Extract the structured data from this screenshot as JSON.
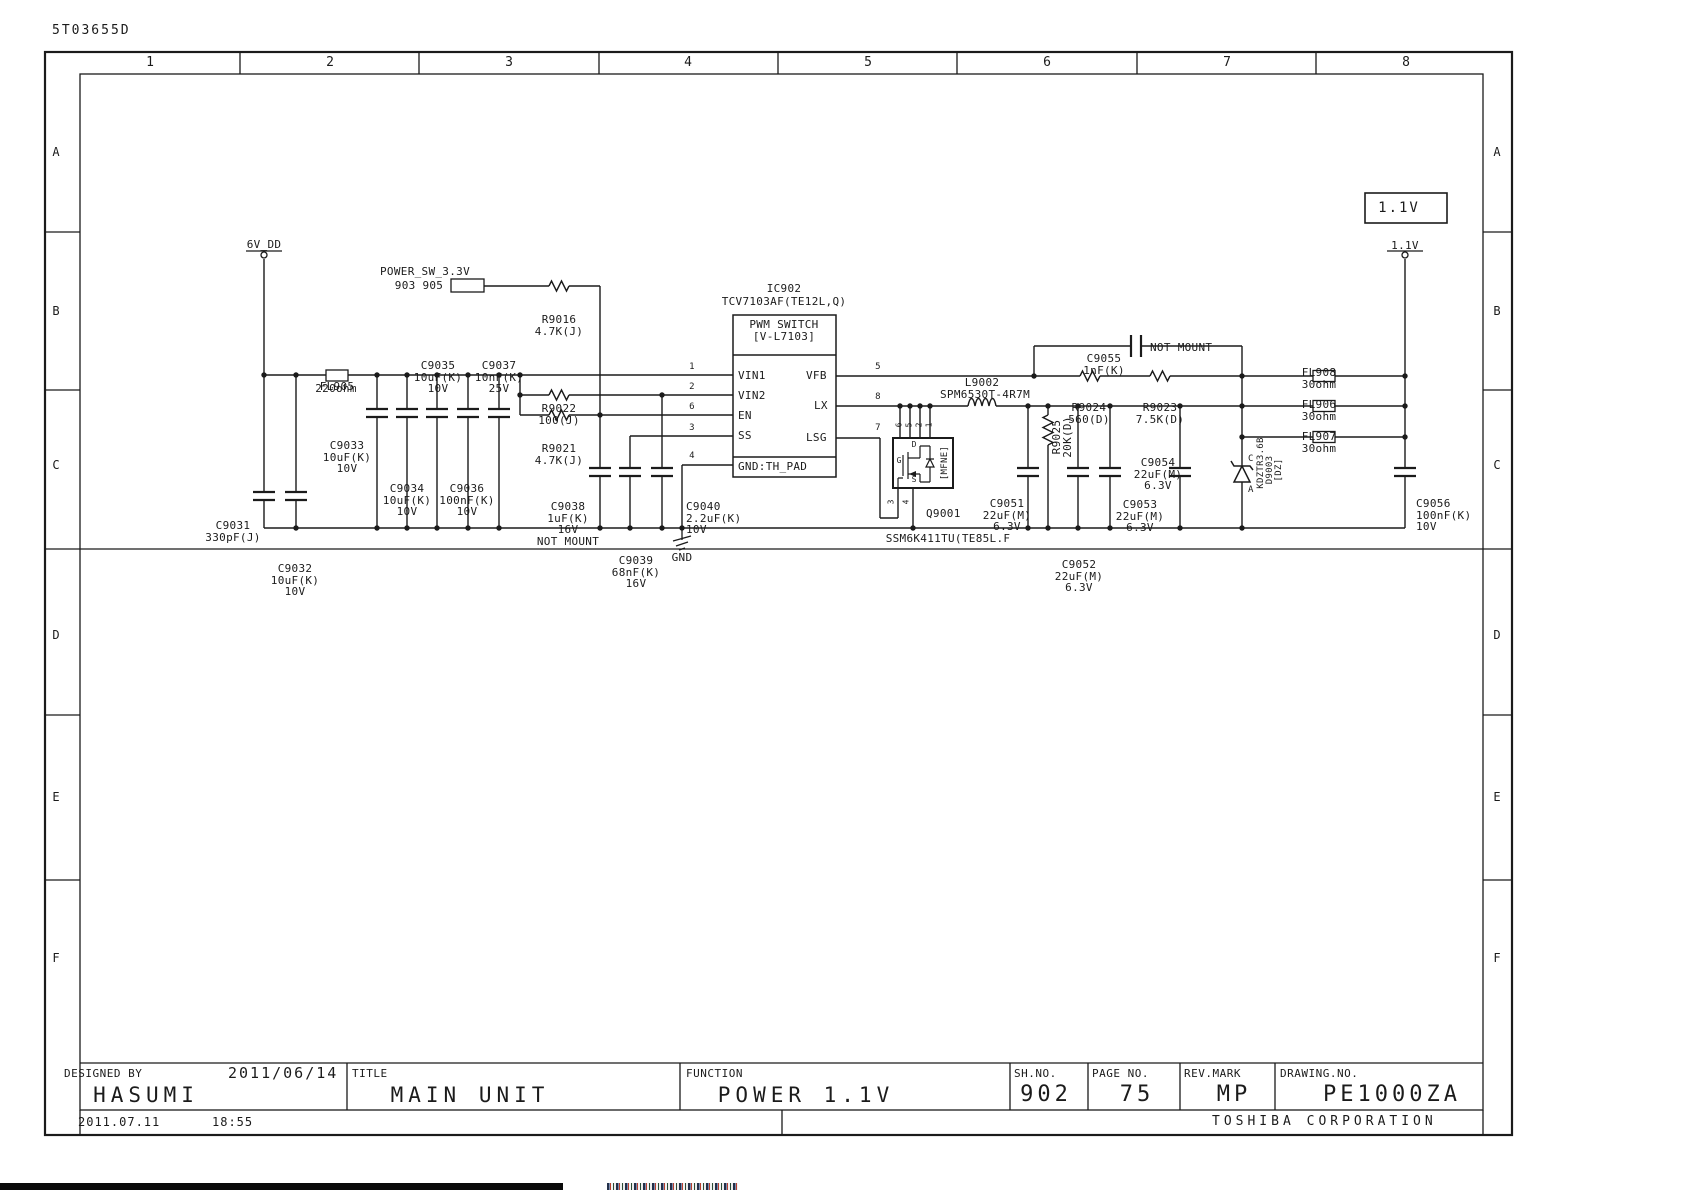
{
  "doc_code": "5T03655D",
  "frame": {
    "columns": [
      "1",
      "2",
      "3",
      "4",
      "5",
      "6",
      "7",
      "8"
    ],
    "rows": [
      "A",
      "B",
      "C",
      "D",
      "E",
      "F"
    ]
  },
  "title_block": {
    "designed_by_label": "DESIGNED BY",
    "design_date": "2011/06/14",
    "designer": "HASUMI",
    "title_label": "TITLE",
    "title": "MAIN UNIT",
    "function_label": "FUNCTION",
    "function": "POWER 1.1V",
    "sheet_no_label": "SH.NO.",
    "sheet_no": "902",
    "page_no_label": "PAGE NO.",
    "page_no": "75",
    "rev_mark_label": "REV.MARK",
    "rev_mark": "MP",
    "drawing_no_label": "DRAWING.NO.",
    "drawing_no": "PE1000ZA",
    "company": "TOSHIBA CORPORATION",
    "print_date": "2011.07.11",
    "print_time": "18:55"
  },
  "nets": {
    "vdd": "6V_DD",
    "power_sw": "POWER_SW_3.3V",
    "power_sw_sheets": "903 905",
    "output_flag": "1.1V",
    "output_net": "1.1V",
    "gnd": "GND"
  },
  "ic902": {
    "ref": "IC902",
    "part": "TCV7103AF(TE12L,Q)",
    "function1": "PWM SWITCH",
    "function2": "[V-L7103]",
    "pins": {
      "vin1": "VIN1",
      "vin2": "VIN2",
      "en": "EN",
      "ss": "SS",
      "gnd_pad": "GND:TH_PAD",
      "vfb": "VFB",
      "lx": "LX",
      "lsg": "LSG",
      "n1": "1",
      "n2": "2",
      "n6": "6",
      "n3": "3",
      "n4": "4",
      "n5": "5",
      "n8": "8",
      "n7": "7"
    }
  },
  "q9001": {
    "ref": "Q9001",
    "part": "SSM6K411TU(TE85L.F",
    "package": "[MFNE]",
    "pin_top_1": "6",
    "pin_top_2": "5",
    "pin_top_3": "2",
    "pin_top_4": "1",
    "pin_bot_1": "3",
    "pin_bot_2": "4",
    "gate": "G",
    "drain": "D",
    "source": "S"
  },
  "d9003": {
    "cathode": "C",
    "anode": "A",
    "part": "KDZTR3.6B",
    "ref": "D9003",
    "type": "[DZ]"
  },
  "l9002": {
    "ref": "L9002",
    "part": "SPM6530T-4R7M"
  },
  "components": {
    "fl905": {
      "ref": "FL905",
      "value": "220ohm"
    },
    "fl906": {
      "ref": "FL906",
      "value": "30ohm"
    },
    "fl907": {
      "ref": "FL907",
      "value": "30ohm"
    },
    "fl908": {
      "ref": "FL908",
      "value": "30ohm"
    },
    "r9016": {
      "ref": "R9016",
      "value": "4.7K(J)"
    },
    "r9021": {
      "ref": "R9021",
      "value": "4.7K(J)"
    },
    "r9022": {
      "ref": "R9022",
      "value": "100(J)"
    },
    "r9023": {
      "ref": "R9023",
      "value": "7.5K(D)"
    },
    "r9024": {
      "ref": "R9024",
      "value": "560(D)"
    },
    "r9025": {
      "ref": "R9025",
      "value": "20K(D)"
    },
    "c9031": {
      "ref": "C9031",
      "value": "330pF(J)"
    },
    "c9032": {
      "ref": "C9032",
      "value": "10uF(K)",
      "voltage": "10V"
    },
    "c9033": {
      "ref": "C9033",
      "value": "10uF(K)",
      "voltage": "10V"
    },
    "c9034": {
      "ref": "C9034",
      "value": "10uF(K)",
      "voltage": "10V"
    },
    "c9035": {
      "ref": "C9035",
      "value": "10uF(K)",
      "voltage": "10V"
    },
    "c9036": {
      "ref": "C9036",
      "value": "100nF(K)",
      "voltage": "10V"
    },
    "c9037": {
      "ref": "C9037",
      "value": "10nF(K)",
      "voltage": "25V"
    },
    "c9038": {
      "ref": "C9038",
      "value": "1uF(K)",
      "voltage": "16V",
      "note": "NOT MOUNT"
    },
    "c9039": {
      "ref": "C9039",
      "value": "68nF(K)",
      "voltage": "16V"
    },
    "c9040": {
      "ref": "C9040",
      "value": "2.2uF(K)",
      "voltage": "10V"
    },
    "c9051": {
      "ref": "C9051",
      "value": "22uF(M)",
      "voltage": "6.3V"
    },
    "c9052": {
      "ref": "C9052",
      "value": "22uF(M)",
      "voltage": "6.3V"
    },
    "c9053": {
      "ref": "C9053",
      "value": "22uF(M)",
      "voltage": "6.3V"
    },
    "c9054": {
      "ref": "C9054",
      "value": "22uF(M)",
      "voltage": "6.3V"
    },
    "c9055": {
      "ref": "C9055",
      "value": "1nF(K)",
      "note": "NOT MOUNT"
    },
    "c9056": {
      "ref": "C9056",
      "value": "100nF(K)",
      "voltage": "10V"
    }
  }
}
